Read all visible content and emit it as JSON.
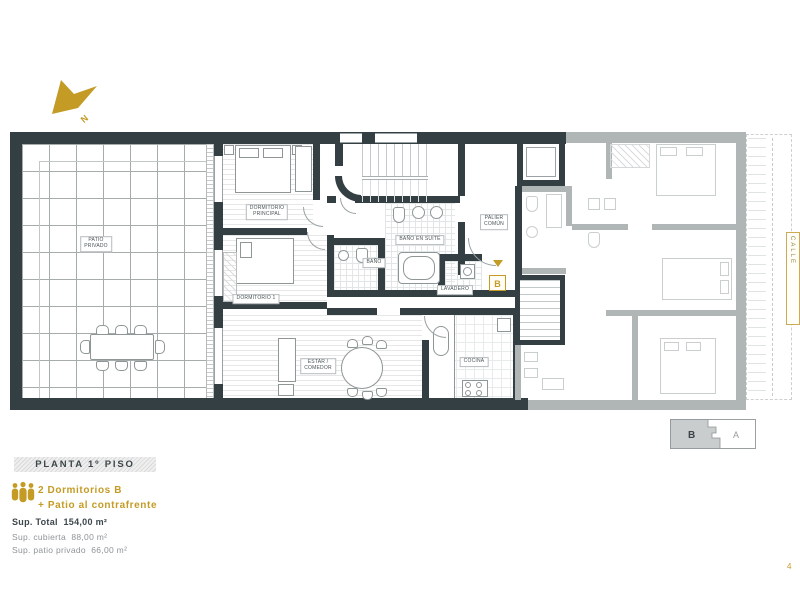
{
  "page": {
    "number": "4"
  },
  "colors": {
    "accent_gold": "#c49b25",
    "wall_dark": "#343f44",
    "wall_gray_unit_a": "#b0b6b6"
  },
  "north": {
    "label": "N"
  },
  "plan": {
    "unit_marker": "B",
    "street_label": "CALLE",
    "rooms": {
      "patio": [
        "PATIO",
        "PRIVADO"
      ],
      "dorm_principal": [
        "DORMITORIO",
        "PRINCIPAL"
      ],
      "dorm_1": [
        "DORMITORIO 1"
      ],
      "bano_suite": [
        "BAÑO EN SUITE"
      ],
      "bano": [
        "BAÑO"
      ],
      "lavadero": [
        "LAVADERO"
      ],
      "palier": [
        "PALIER",
        "COMÚN"
      ],
      "estar": [
        "ESTAR /",
        "COMEDOR"
      ],
      "cocina": [
        "COCINA"
      ]
    }
  },
  "legend": {
    "title": "PLANTA 1º PISO",
    "unit_type": "2 Dormitorios B",
    "unit_feature": "+ Patio al contrafrente",
    "sup_total_label": "Sup. Total",
    "sup_total_value": "154,00 m²",
    "sup_cubierta_label": "Sup. cubierta",
    "sup_cubierta_value": "88,00 m²",
    "sup_patio_label": "Sup. patio privado",
    "sup_patio_value": "66,00 m²"
  },
  "keyplan": {
    "unit_b": "B",
    "unit_a": "A"
  }
}
